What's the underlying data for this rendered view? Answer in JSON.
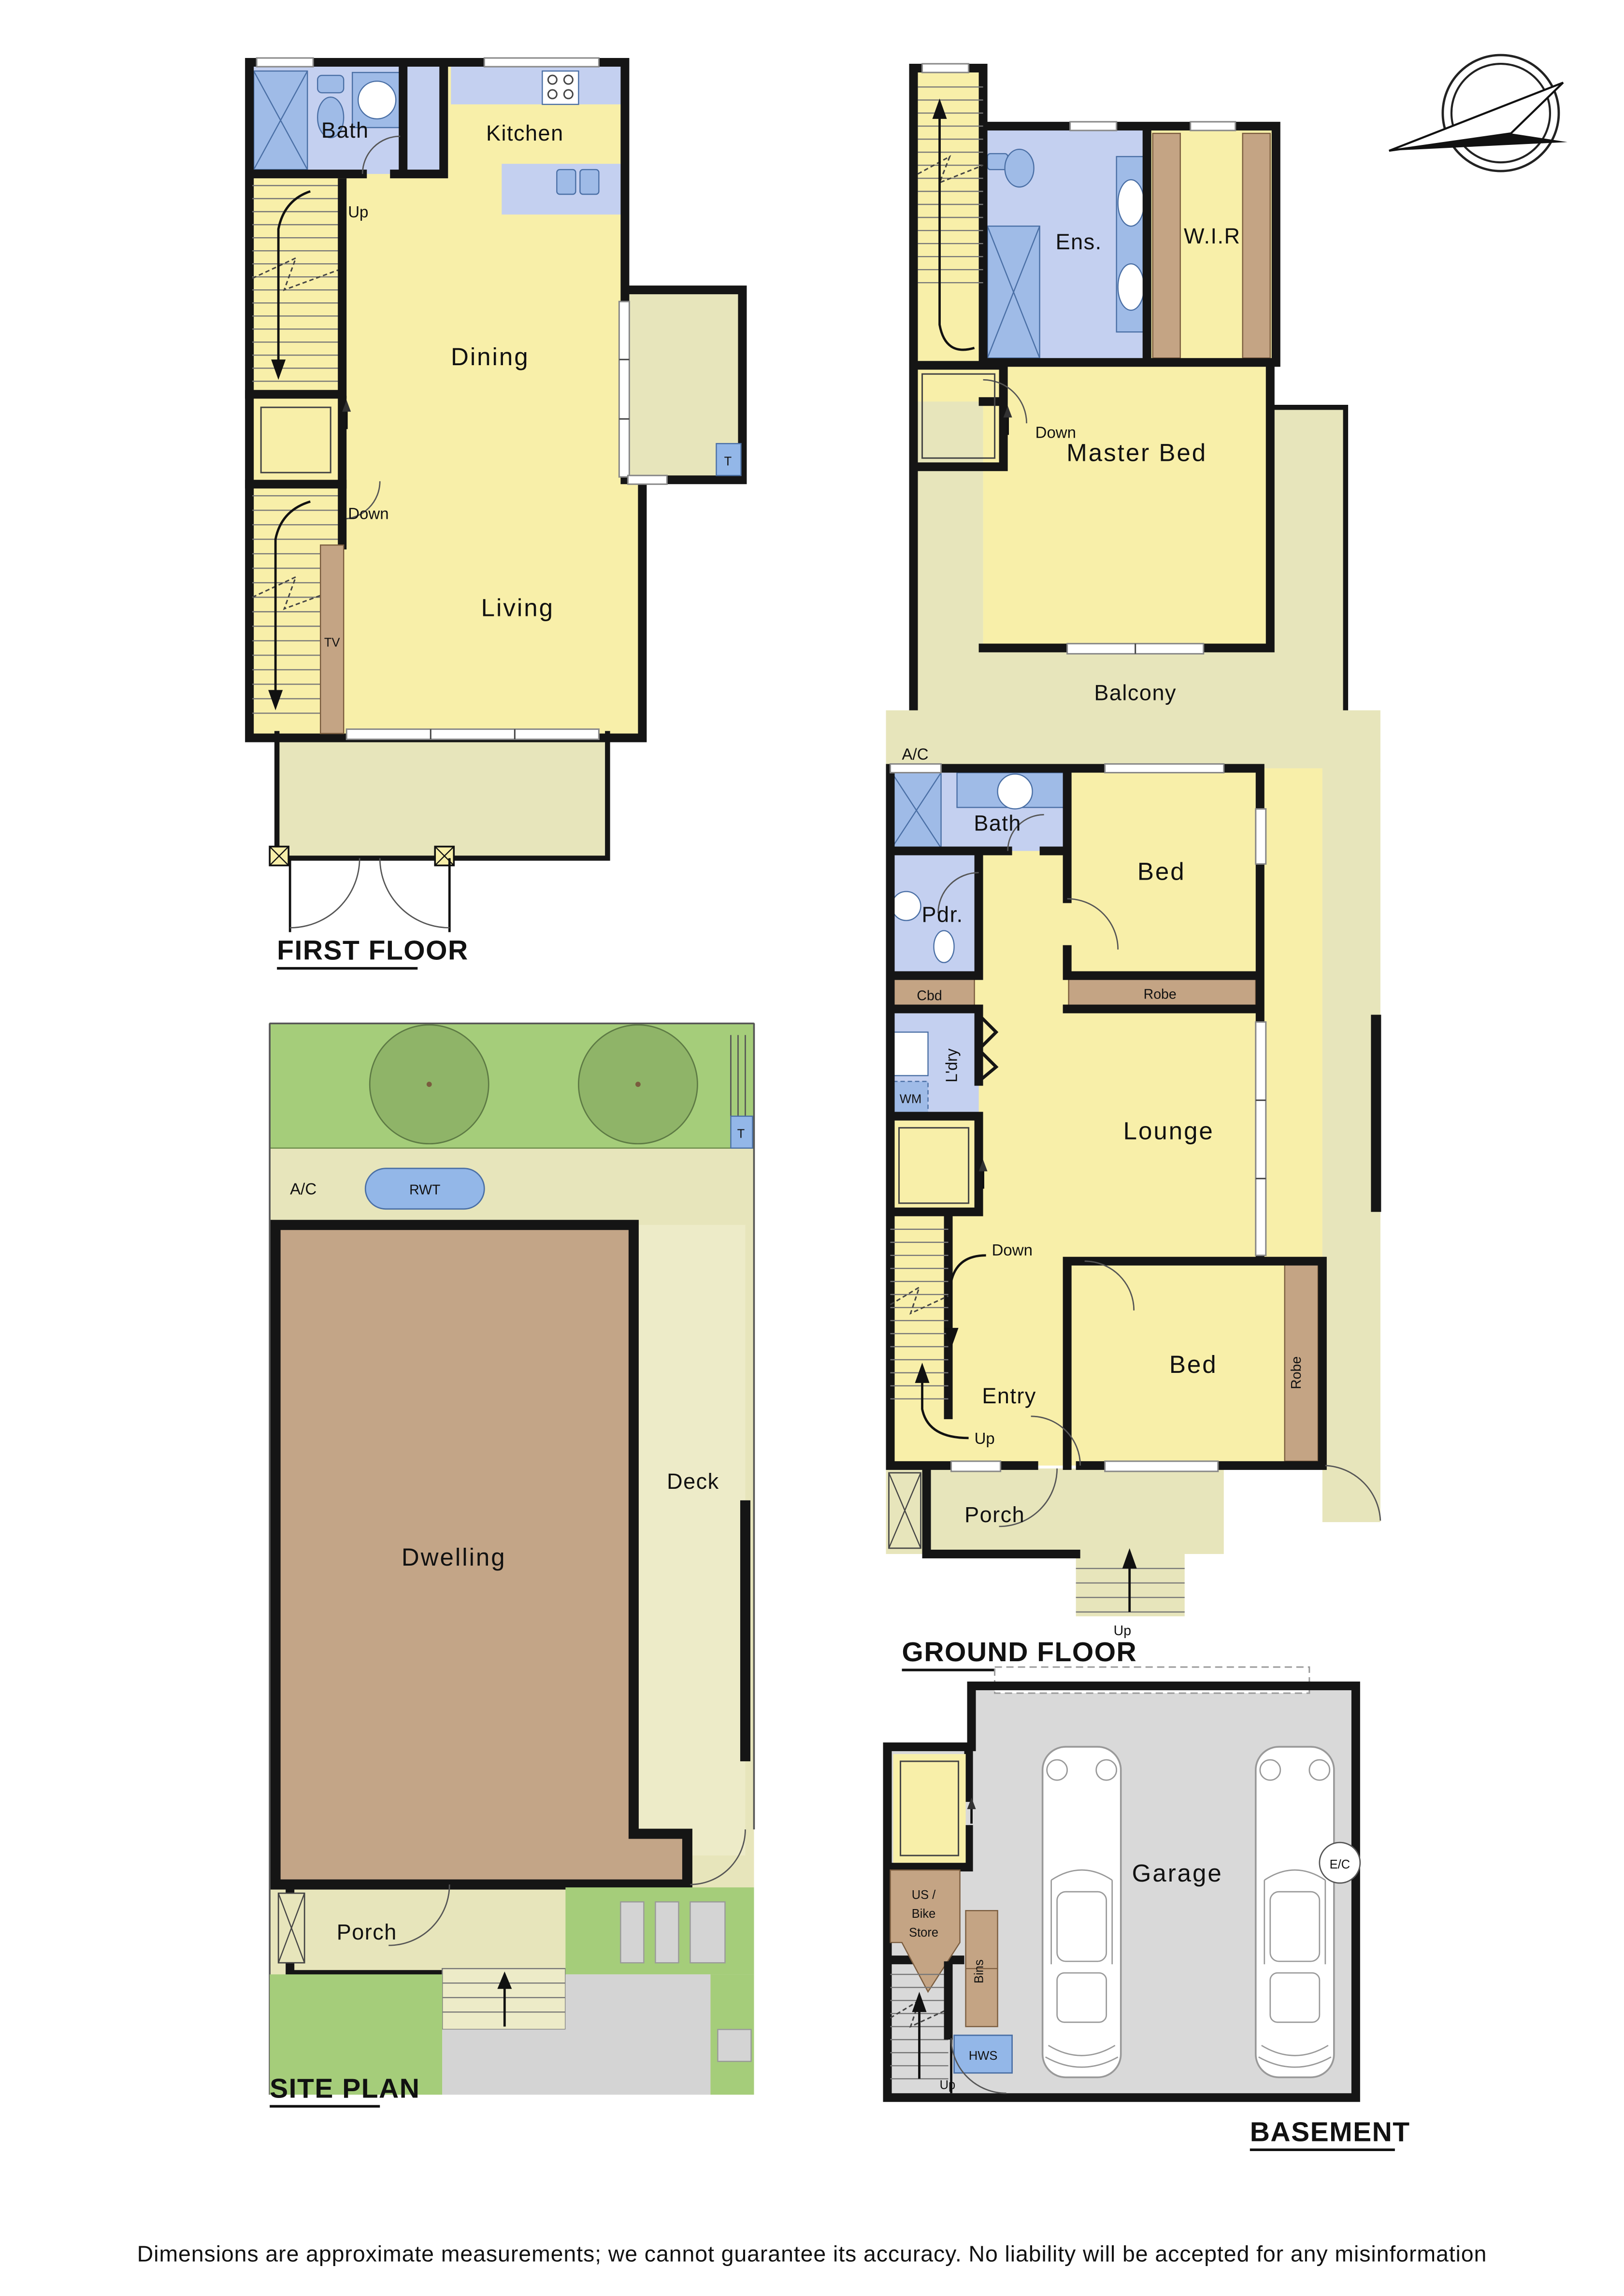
{
  "disclaimer": "Dimensions are approximate measurements; we cannot guarantee its accuracy. No liability will be accepted for any misinformation",
  "colors": {
    "room_yellow": "#F8EFA9",
    "outdoor_olive": "#E7E5BB",
    "deck_pale": "#EDEBC8",
    "wet_blue": "#C4D0F0",
    "fixture_blue": "#9FBBE7",
    "tag_blue": "#93B7E8",
    "joinery_brown": "#C4A484",
    "dwelling_brown": "#C3A587",
    "grass_green": "#A5CD7A",
    "tree_green": "#8FB468",
    "garage_grey": "#D9D9D9",
    "wall_black": "#151515"
  },
  "first_floor": {
    "title": "FIRST FLOOR",
    "rooms": {
      "bath": "Bath",
      "kitchen": "Kitchen",
      "dining": "Dining",
      "living": "Living"
    },
    "labels": {
      "up": "Up",
      "down": "Down",
      "tv": "TV",
      "t": "T"
    }
  },
  "second_floor": {
    "title": "SECOND FLOOR",
    "rooms": {
      "ens": "Ens.",
      "wir": "W.I.R",
      "master": "Master Bed",
      "balcony": "Balcony"
    },
    "labels": {
      "down": "Down"
    }
  },
  "ground_floor": {
    "title": "GROUND FLOOR",
    "rooms": {
      "bath": "Bath",
      "bed1": "Bed",
      "pdr": "Pdr.",
      "cbd": "Cbd",
      "ldry": "L'dry",
      "lounge": "Lounge",
      "entry": "Entry",
      "bed2": "Bed",
      "porch": "Porch"
    },
    "labels": {
      "ac": "A/C",
      "wm": "WM",
      "robe1": "Robe",
      "robe2": "Robe",
      "down": "Down",
      "up_stairs": "Up",
      "up_steps": "Up"
    }
  },
  "site_plan": {
    "title": "SITE PLAN",
    "rooms": {
      "dwelling": "Dwelling",
      "deck": "Deck",
      "porch": "Porch"
    },
    "labels": {
      "ac": "A/C",
      "rwt": "RWT",
      "t": "T",
      "up": "Up"
    }
  },
  "basement": {
    "title": "BASEMENT",
    "rooms": {
      "garage": "Garage"
    },
    "labels": {
      "ec": "E/C",
      "store1": "US /",
      "store2": "Bike",
      "store3": "Store",
      "bins": "Bins",
      "hws": "HWS",
      "up": "Up"
    }
  }
}
